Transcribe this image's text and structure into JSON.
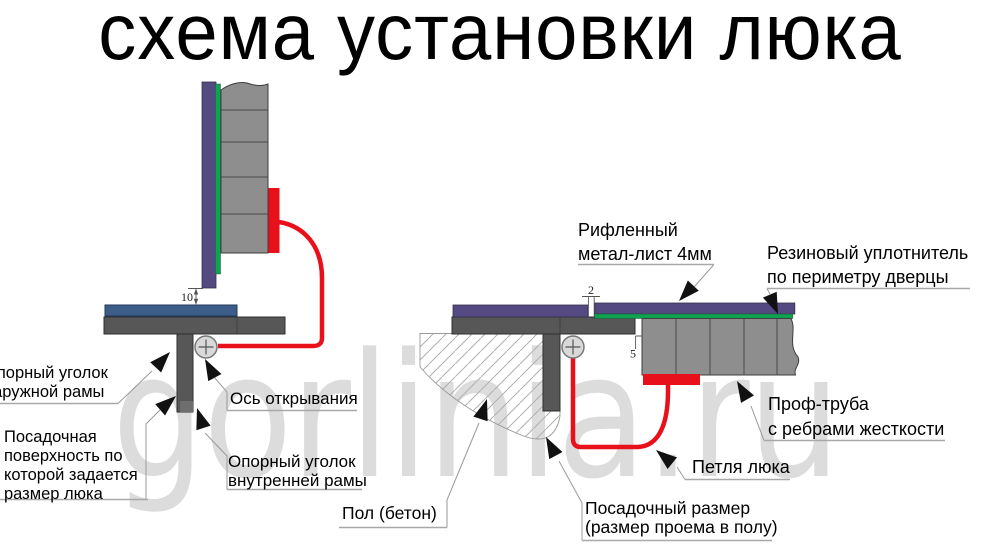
{
  "title": "схема установки люка",
  "watermark": "gorlinia.ru",
  "colors": {
    "purple": "#544a81",
    "green": "#0fa251",
    "red": "#e8111b",
    "gray_tube": "#8e8e8e",
    "frame_gray": "#575757",
    "frame_cap": "#6e6e6e",
    "steel_blue": "#3d5c87",
    "circle_fill": "#d9d9d9",
    "watermark_gray": "#dcdcdc",
    "arrow_black": "#111111"
  },
  "left_diagram": {
    "dimension_gap": "10",
    "labels": {
      "outer_angle": "Опорный уголок\nнаружной рамы",
      "seating_surface": "Посадочная\nповерхность по\nкоторой задается\nразмер люка",
      "opening_axis": "Ось открывания",
      "inner_angle": "Опорный уголок\nвнутренней рамы"
    }
  },
  "right_diagram": {
    "dimension_sheet_gap": "2",
    "dimension_side_gap": "5",
    "labels": {
      "sheet": "Рифленный\nметал-лист 4мм",
      "seal": "Резиновый уплотнитель\nпо периметру дверцы",
      "tube": "Проф-труба\nс ребрами жесткости",
      "hinge": "Петля люка",
      "floor": "Пол (бетон)",
      "fit_size": "Посадочный размер\n(размер проема в полу)"
    }
  }
}
